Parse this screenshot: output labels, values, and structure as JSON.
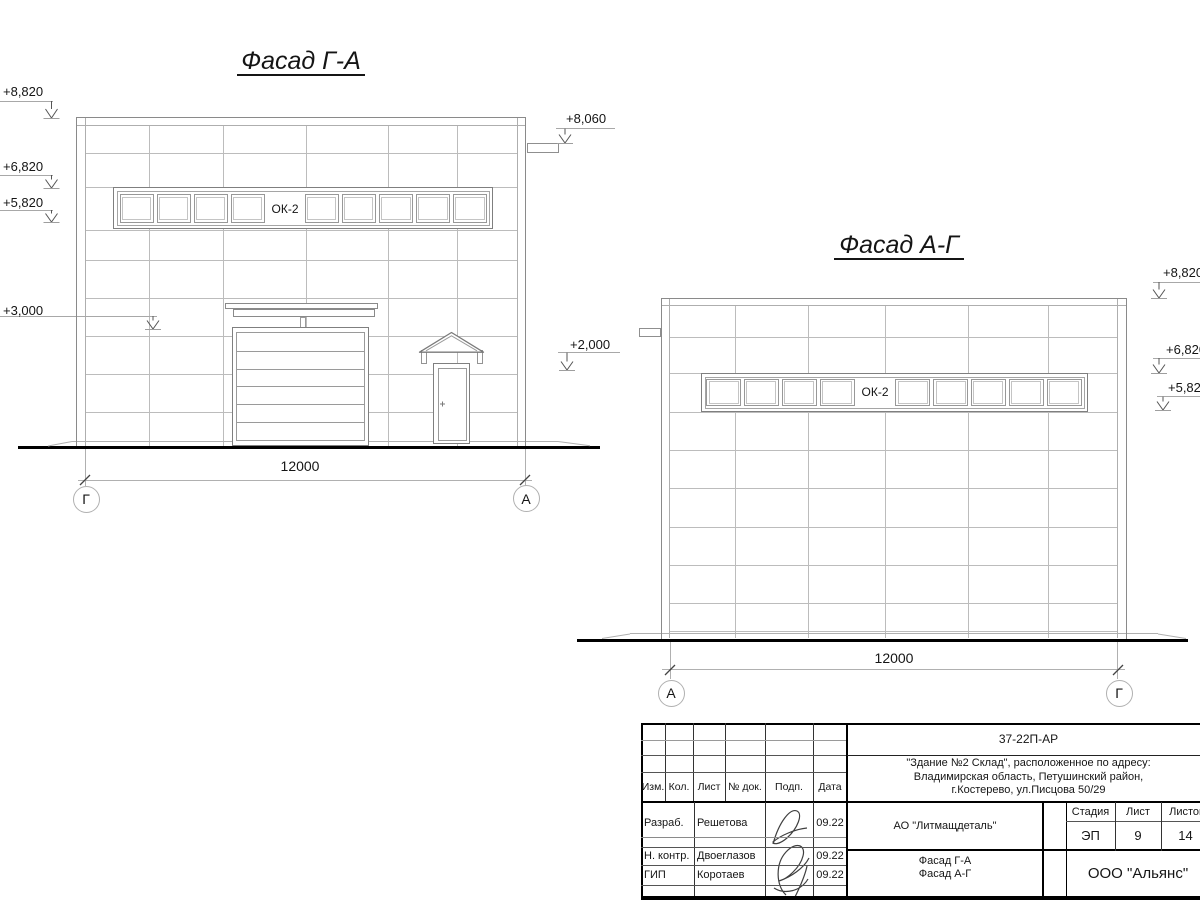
{
  "colors": {
    "ink": "#151515",
    "grid_line": "#bcbcbc",
    "outline": "#7f7f7f",
    "thick_line": "#000000"
  },
  "facade_ga": {
    "title": "Фасад Г-А",
    "window_label": "ОК-2",
    "dimension": "12000",
    "axis_left": "Г",
    "axis_right": "А",
    "elevations_left": [
      "+8,820",
      "+6,820",
      "+5,820",
      "+3,000"
    ],
    "elevations_right": [
      "+8,060",
      "+2,000"
    ]
  },
  "facade_ag": {
    "title": "Фасад А-Г",
    "window_label": "ОК-2",
    "dimension": "12000",
    "axis_left": "А",
    "axis_right": "Г",
    "elevations_right": [
      "+8,820",
      "+6,820",
      "+5,820"
    ]
  },
  "title_block": {
    "doc_code": "37-22П-АР",
    "address_lines": [
      "\"Здание №2 Склад\", расположенное по адресу:",
      "Владимирская область, Петушинский район,",
      "г.Костерево, ул.Писцова 50/29"
    ],
    "columns": [
      "Изм.",
      "Кол.",
      "Лист",
      "№ док.",
      "Подп.",
      "Дата"
    ],
    "rows": [
      {
        "role": "Разраб.",
        "name": "Решетова",
        "date": "09.22"
      },
      {
        "role": "Н. контр.",
        "name": "Двоеглазов",
        "date": "09.22"
      },
      {
        "role": "ГИП",
        "name": "Коротаев",
        "date": "09.22"
      }
    ],
    "customer": "АО \"Литмащдеталь\"",
    "stage_label": "Стадия",
    "sheet_label": "Лист",
    "sheets_label": "Листов",
    "stage": "ЭП",
    "sheet": "9",
    "sheets_total": "14",
    "sheet_title_lines": [
      "Фасад Г-А",
      "Фасад А-Г"
    ],
    "company": "ООО \"Альянс\""
  }
}
